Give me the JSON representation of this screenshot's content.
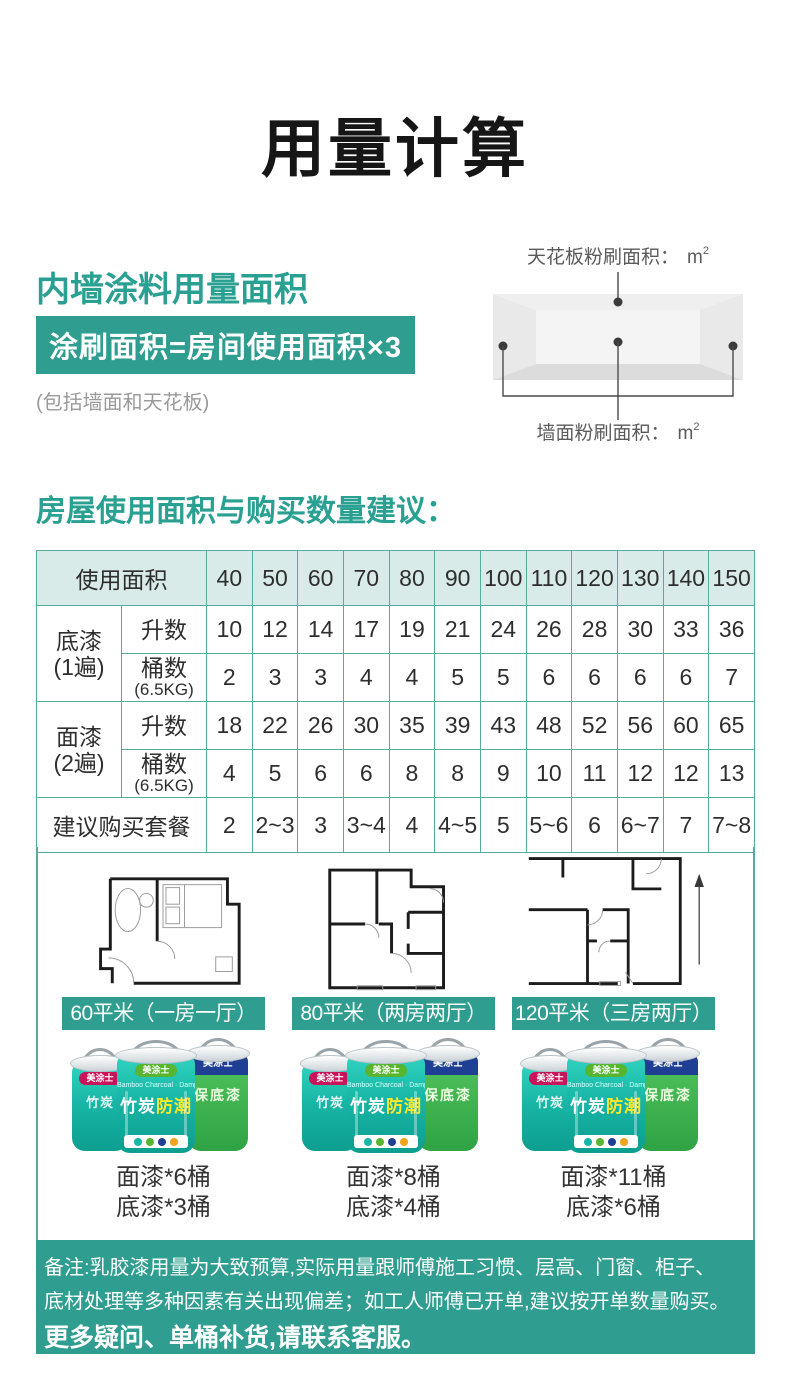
{
  "page": {
    "title": "用量计算"
  },
  "section1": {
    "heading": "内墙涂料用量面积",
    "formula": "涂刷面积=房间使用面积×3",
    "note": "(包括墙面和天花板)",
    "diagram": {
      "ceiling_label": "天花板粉刷面积：",
      "wall_label": "墙面粉刷面积：",
      "unit": "m",
      "unit_power": "2"
    }
  },
  "section2": {
    "heading": "房屋使用面积与购买数量建议：",
    "table": {
      "area_header": "使用面积",
      "areas": [
        "40",
        "50",
        "60",
        "70",
        "80",
        "90",
        "100",
        "110",
        "120",
        "130",
        "140",
        "150"
      ],
      "groups": [
        {
          "name": "底漆",
          "coats": "(1遍)",
          "rows": [
            {
              "label": "升数",
              "values": [
                "10",
                "12",
                "14",
                "17",
                "19",
                "21",
                "24",
                "26",
                "28",
                "30",
                "33",
                "36"
              ]
            },
            {
              "label": "桶数",
              "sublabel": "(6.5KG)",
              "values": [
                "2",
                "3",
                "3",
                "4",
                "4",
                "5",
                "5",
                "6",
                "6",
                "6",
                "6",
                "7"
              ]
            }
          ]
        },
        {
          "name": "面漆",
          "coats": "(2遍)",
          "rows": [
            {
              "label": "升数",
              "values": [
                "18",
                "22",
                "26",
                "30",
                "35",
                "39",
                "43",
                "48",
                "52",
                "56",
                "60",
                "65"
              ]
            },
            {
              "label": "桶数",
              "sublabel": "(6.5KG)",
              "values": [
                "4",
                "5",
                "6",
                "6",
                "8",
                "8",
                "9",
                "10",
                "11",
                "12",
                "12",
                "13"
              ]
            }
          ]
        }
      ],
      "suggestion": {
        "label": "建议购买套餐",
        "values": [
          "2",
          "2~3",
          "3",
          "3~4",
          "4",
          "4~5",
          "5",
          "5~6",
          "6",
          "6~7",
          "7",
          "7~8"
        ]
      }
    },
    "plans": [
      {
        "label": "60平米（一房一厅）",
        "topcoat": "面漆*6桶",
        "primer": "底漆*3桶"
      },
      {
        "label": "80平米（两房两厅）",
        "topcoat": "面漆*8桶",
        "primer": "底漆*4桶"
      },
      {
        "label": "120平米（三房两厅）",
        "topcoat": "面漆*11桶",
        "primer": "底漆*6桶"
      }
    ],
    "bucket": {
      "brand": "美涂士",
      "en_line": "Bamboo Charcoal · Damp-proof",
      "main1": "竹炭",
      "main2": "防潮",
      "back_label": "保底漆"
    }
  },
  "footer": {
    "line1": "备注:乳胶漆用量为大致预算,实际用量跟师傅施工习惯、层高、门窗、柜子、",
    "line2": "底材处理等多种因素有关出现偏差；如工人师傅已开单,建议按开单数量购买。",
    "line3": "更多疑问、单桶补货,请联系客服。"
  },
  "colors": {
    "accent_teal": "#2f9e90",
    "table_border": "#54aba0",
    "table_header_bg": "#d9ebe8",
    "highlight_yellow": "#ffe92a",
    "bucket_teal": "#18b6a6",
    "bucket_green": "#3fae4c",
    "band_blue": "#1e3f94"
  }
}
